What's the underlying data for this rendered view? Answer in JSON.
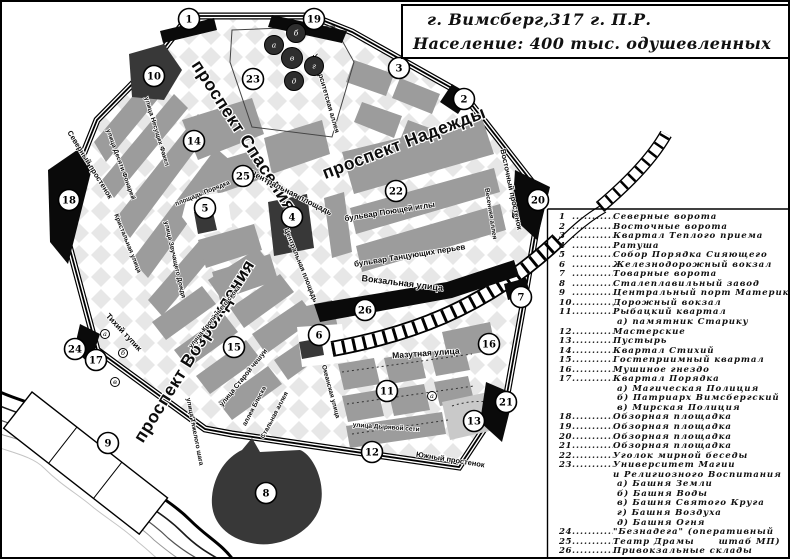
{
  "title": {
    "line1": "г. Вимсберг,317 г. П.Р.",
    "line2": "Население: 400  тыс. одушевленных"
  },
  "colors": {
    "map_block": "#9c9c9c",
    "map_dark": "#383838",
    "map_black": "#0a0a0a",
    "diamond": "#e7e7e7",
    "background": "#ffffff"
  },
  "legend": {
    "items": [
      {
        "num": "1",
        "text": "Северные ворота"
      },
      {
        "num": "2",
        "text": "Восточные ворота"
      },
      {
        "num": "3",
        "text": "Квартал Теплого приема"
      },
      {
        "num": "4",
        "text": "Ратуша"
      },
      {
        "num": "5",
        "text": "Собор Порядка Сияющего"
      },
      {
        "num": "6",
        "text": "Железнодорожный вокзал"
      },
      {
        "num": "7",
        "text": "Товарные ворота"
      },
      {
        "num": "8",
        "text": "Сталеплавильный завод"
      },
      {
        "num": "9",
        "text": "Центральный порт Материка"
      },
      {
        "num": "10",
        "text": "Дорожный вокзал"
      },
      {
        "num": "11",
        "text": "Рыбацкий квартал",
        "subs": [
          {
            "l": "а)",
            "t": "памятник Старику"
          }
        ]
      },
      {
        "num": "12",
        "text": "Мастерские"
      },
      {
        "num": "13",
        "text": "Пустырь"
      },
      {
        "num": "14",
        "text": "Квартал Стихий"
      },
      {
        "num": "15",
        "text": "Гостеприимный квартал"
      },
      {
        "num": "16",
        "text": "Мушиное гнездо"
      },
      {
        "num": "17",
        "text": "Квартал Порядка",
        "subs": [
          {
            "l": "а)",
            "t": "Магическая Полиция"
          },
          {
            "l": "б)",
            "t": "Патриарх Вимсбергский"
          },
          {
            "l": "в)",
            "t": "Мирская Полиция"
          }
        ]
      },
      {
        "num": "18",
        "text": "Обзорная площадка"
      },
      {
        "num": "19",
        "text": "Обзорная площадка"
      },
      {
        "num": "20",
        "text": "Обзорная площадка"
      },
      {
        "num": "21",
        "text": "Обзорная площадка"
      },
      {
        "num": "22",
        "text": "Уголок мирной беседы"
      },
      {
        "num": "23",
        "text": "Университет Магии",
        "text2": "и Религиозного Воспитания",
        "subs": [
          {
            "l": "а)",
            "t": "Башня Земли"
          },
          {
            "l": "б)",
            "t": "Башня Воды"
          },
          {
            "l": "в)",
            "t": "Башня Святого Круга"
          },
          {
            "l": "г)",
            "t": "Башня Воздуха"
          },
          {
            "l": "д)",
            "t": "Башня Огня"
          }
        ]
      },
      {
        "num": "24",
        "text": "\"Безнадега\" (оперативный"
      },
      {
        "num": "25",
        "text": "Театр Драмы",
        "note": "штаб МП)"
      },
      {
        "num": "26",
        "text": "Привокзальные склады"
      }
    ]
  },
  "map": {
    "street_labels": [
      {
        "t": "проспект Спасения",
        "x": 237,
        "y": 137,
        "r": 57,
        "s": 17.5,
        "big": true
      },
      {
        "t": "проспект Надежды",
        "x": 404,
        "y": 146,
        "r": -21,
        "s": 17.5,
        "big": true
      },
      {
        "t": "проспект Возрождения",
        "x": 197,
        "y": 352,
        "r": -58,
        "s": 17.5,
        "big": true
      },
      {
        "t": "Северный простенок",
        "x": 86,
        "y": 164,
        "r": 58,
        "s": 7.5
      },
      {
        "t": "Восточный простенок",
        "x": 507,
        "y": 188,
        "r": 78,
        "s": 7.5
      },
      {
        "t": "Южный простенок",
        "x": 448,
        "y": 460,
        "r": 9,
        "s": 7.5
      },
      {
        "t": "Вокзальная улица",
        "x": 400,
        "y": 284,
        "r": 7,
        "s": 9
      },
      {
        "t": "Мазутная улица",
        "x": 424,
        "y": 354,
        "r": -4,
        "s": 8.5
      },
      {
        "t": "Центральная площадь",
        "x": 288,
        "y": 193,
        "r": 27,
        "s": 8
      },
      {
        "t": "Центральная площадь",
        "x": 297,
        "y": 264,
        "r": 68,
        "s": 7
      },
      {
        "t": "бульвар Поющей иглы",
        "x": 388,
        "y": 212,
        "r": -9,
        "s": 8
      },
      {
        "t": "бульвар Танцующих перьев",
        "x": 408,
        "y": 256,
        "r": -9,
        "s": 8
      },
      {
        "t": "Университетская аллея",
        "x": 322,
        "y": 92,
        "r": 74,
        "s": 7
      },
      {
        "t": "Тихий тупик",
        "x": 120,
        "y": 332,
        "r": 47,
        "s": 8
      },
      {
        "t": "улица Старой чешуи",
        "x": 243,
        "y": 377,
        "r": -51,
        "s": 7
      },
      {
        "t": "аллея Блеска",
        "x": 254,
        "y": 405,
        "r": -62,
        "s": 6.5
      },
      {
        "t": "Стальная аллея",
        "x": 274,
        "y": 414,
        "r": -62,
        "s": 6.5
      },
      {
        "t": "улица Несущих Факел",
        "x": 153,
        "y": 130,
        "r": 73,
        "s": 6.5
      },
      {
        "t": "улица Десяти Фонарей",
        "x": 117,
        "y": 163,
        "r": 70,
        "s": 6.5
      },
      {
        "t": "Кристальная улица",
        "x": 124,
        "y": 242,
        "r": 68,
        "s": 6.5
      },
      {
        "t": "улица Звучащего Дождя",
        "x": 171,
        "y": 258,
        "r": 77,
        "s": 6.5
      },
      {
        "t": "площадь Порядка",
        "x": 201,
        "y": 193,
        "r": -22,
        "s": 6.5
      },
      {
        "t": "улица Дырявой сети",
        "x": 384,
        "y": 427,
        "r": 4,
        "s": 6.5
      },
      {
        "t": "улица Тяжелого шага",
        "x": 191,
        "y": 430,
        "r": 79,
        "s": 6.5
      },
      {
        "t": "Океанская улица",
        "x": 327,
        "y": 390,
        "r": 75,
        "s": 6.5
      },
      {
        "t": "Весенняя аллея",
        "x": 487,
        "y": 212,
        "r": 81,
        "s": 6.5
      },
      {
        "t": "улица Кроличьего скока",
        "x": 214,
        "y": 316,
        "r": -51,
        "s": 6.5
      }
    ],
    "markers": [
      {
        "n": "1",
        "x": 187,
        "y": 17
      },
      {
        "n": "2",
        "x": 462,
        "y": 97
      },
      {
        "n": "3",
        "x": 397,
        "y": 66
      },
      {
        "n": "4",
        "x": 290,
        "y": 215
      },
      {
        "n": "5",
        "x": 203,
        "y": 206
      },
      {
        "n": "6",
        "x": 317,
        "y": 333
      },
      {
        "n": "7",
        "x": 519,
        "y": 295
      },
      {
        "n": "8",
        "x": 264,
        "y": 491
      },
      {
        "n": "9",
        "x": 106,
        "y": 441
      },
      {
        "n": "10",
        "x": 152,
        "y": 74
      },
      {
        "n": "11",
        "x": 385,
        "y": 389
      },
      {
        "n": "12",
        "x": 370,
        "y": 450
      },
      {
        "n": "13",
        "x": 472,
        "y": 419
      },
      {
        "n": "14",
        "x": 192,
        "y": 139
      },
      {
        "n": "15",
        "x": 232,
        "y": 345
      },
      {
        "n": "16",
        "x": 487,
        "y": 342
      },
      {
        "n": "17",
        "x": 94,
        "y": 358
      },
      {
        "n": "18",
        "x": 67,
        "y": 198
      },
      {
        "n": "19",
        "x": 312,
        "y": 17
      },
      {
        "n": "20",
        "x": 536,
        "y": 198
      },
      {
        "n": "21",
        "x": 504,
        "y": 400
      },
      {
        "n": "22",
        "x": 394,
        "y": 189
      },
      {
        "n": "23",
        "x": 251,
        "y": 77
      },
      {
        "n": "24",
        "x": 73,
        "y": 347
      },
      {
        "n": "25",
        "x": 241,
        "y": 174
      },
      {
        "n": "26",
        "x": 363,
        "y": 308
      }
    ],
    "sub_markers": [
      {
        "l": "а",
        "x": 430,
        "y": 394
      },
      {
        "l": "а",
        "x": 103,
        "y": 332
      },
      {
        "l": "б",
        "x": 121,
        "y": 351
      },
      {
        "l": "в",
        "x": 113,
        "y": 380
      }
    ],
    "towers": [
      {
        "l": "а",
        "x": 272,
        "y": 43,
        "r": 9.5
      },
      {
        "l": "б",
        "x": 294,
        "y": 31,
        "r": 9.5
      },
      {
        "l": "в",
        "x": 290,
        "y": 56,
        "r": 10.5
      },
      {
        "l": "г",
        "x": 312,
        "y": 64,
        "r": 9.5
      },
      {
        "l": "д",
        "x": 292,
        "y": 79,
        "r": 9.5
      }
    ]
  }
}
